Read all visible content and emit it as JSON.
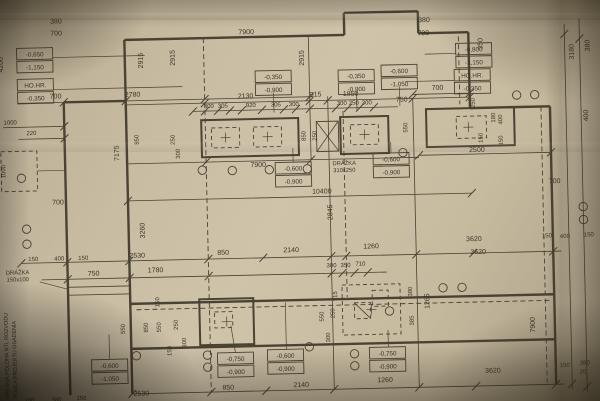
{
  "meta": {
    "width": 600,
    "height": 401,
    "rotation_deg": -1.3,
    "paper_color": "#c9bda4",
    "line_color": "#4a4233",
    "text_color": "#3a3327"
  },
  "plan": {
    "walls": [
      [
        128,
        36,
        348,
        36
      ],
      [
        348,
        14,
        348,
        36
      ],
      [
        348,
        14,
        422,
        14
      ],
      [
        422,
        14,
        422,
        36
      ],
      [
        422,
        36,
        472,
        36
      ],
      [
        472,
        36,
        472,
        112
      ],
      [
        472,
        112,
        552,
        112
      ],
      [
        552,
        112,
        552,
        390
      ],
      [
        66,
        97,
        128,
        97
      ],
      [
        66,
        97,
        66,
        390
      ],
      [
        128,
        36,
        128,
        390
      ],
      [
        128,
        300,
        552,
        300
      ],
      [
        128,
        345,
        552,
        345
      ]
    ],
    "thin_lines": [
      [
        20,
        97,
        315,
        97
      ],
      [
        128,
        101,
        472,
        101
      ],
      [
        195,
        109,
        400,
        109
      ],
      [
        128,
        160,
        420,
        160
      ],
      [
        128,
        197,
        472,
        197
      ],
      [
        20,
        257,
        560,
        257
      ],
      [
        40,
        274,
        385,
        274
      ],
      [
        128,
        390,
        560,
        390
      ],
      [
        420,
        158,
        552,
        158
      ],
      [
        415,
        97,
        472,
        97
      ],
      [
        5,
        121,
        66,
        121
      ],
      [
        20,
        133,
        66,
        133
      ],
      [
        312,
        36,
        312,
        160
      ],
      [
        330,
        97,
        330,
        390
      ],
      [
        415,
        101,
        415,
        390
      ],
      [
        568,
        30,
        568,
        395
      ],
      [
        583,
        25,
        583,
        398
      ],
      [
        66,
        282,
        128,
        282
      ],
      [
        66,
        290,
        128,
        290
      ]
    ],
    "dashed_lines": [
      [
        207,
        36,
        207,
        390
      ],
      [
        462,
        40,
        462,
        108
      ],
      [
        543,
        112,
        543,
        388
      ],
      [
        345,
        112,
        345,
        298
      ],
      [
        134,
        306,
        548,
        306
      ]
    ],
    "rects": [
      {
        "x": 203,
        "y": 118,
        "w": 97,
        "h": 37,
        "s": "heavy"
      },
      {
        "x": 342,
        "y": 118,
        "w": 48,
        "h": 37,
        "s": "heavy"
      },
      {
        "x": 428,
        "y": 112,
        "w": 88,
        "h": 38,
        "s": "heavy"
      },
      {
        "x": 197,
        "y": 297,
        "w": 54,
        "h": 46,
        "s": "heavy"
      },
      {
        "x": 318,
        "y": 122,
        "w": 22,
        "h": 30,
        "s": "thin"
      },
      {
        "x": 213,
        "y": 126,
        "w": 28,
        "h": 20,
        "d": 1
      },
      {
        "x": 255,
        "y": 126,
        "w": 28,
        "h": 20,
        "d": 1
      },
      {
        "x": 352,
        "y": 126,
        "w": 28,
        "h": 20,
        "d": 1
      },
      {
        "x": 458,
        "y": 120,
        "w": 30,
        "h": 22,
        "d": 1
      },
      {
        "x": 212,
        "y": 310,
        "w": 18,
        "h": 16,
        "d": 1
      },
      {
        "x": 340,
        "y": 286,
        "w": 58,
        "h": 50,
        "d": 1
      },
      {
        "x": 352,
        "y": 304,
        "w": 16,
        "h": 16,
        "d": 1
      },
      {
        "x": 370,
        "y": 292,
        "w": 16,
        "h": 16,
        "d": 1
      },
      {
        "x": 2,
        "y": 145,
        "w": 36,
        "h": 40,
        "d": 1
      }
    ],
    "diagonals": [
      [
        318,
        122,
        340,
        152
      ],
      [
        340,
        122,
        318,
        152
      ],
      [
        352,
        304,
        368,
        320
      ]
    ],
    "ticks": [
      [
        66,
        97
      ],
      [
        128,
        97
      ],
      [
        207,
        97
      ],
      [
        312,
        97
      ],
      [
        207,
        101
      ],
      [
        312,
        101
      ],
      [
        330,
        101
      ],
      [
        415,
        101
      ],
      [
        472,
        101
      ],
      [
        195,
        109
      ],
      [
        207,
        109
      ],
      [
        220,
        109
      ],
      [
        232,
        109
      ],
      [
        244,
        109
      ],
      [
        264,
        109
      ],
      [
        286,
        109
      ],
      [
        298,
        109
      ],
      [
        312,
        109
      ],
      [
        338,
        109
      ],
      [
        350,
        109
      ],
      [
        362,
        109
      ],
      [
        376,
        109
      ],
      [
        207,
        160
      ],
      [
        312,
        160
      ],
      [
        128,
        197
      ],
      [
        472,
        197
      ],
      [
        20,
        257
      ],
      [
        66,
        257
      ],
      [
        128,
        257
      ],
      [
        207,
        257
      ],
      [
        262,
        257
      ],
      [
        330,
        257
      ],
      [
        345,
        257
      ],
      [
        415,
        257
      ],
      [
        472,
        257
      ],
      [
        552,
        257
      ],
      [
        66,
        274
      ],
      [
        128,
        274
      ],
      [
        207,
        274
      ],
      [
        330,
        274
      ],
      [
        341,
        274
      ],
      [
        353,
        274
      ],
      [
        366,
        274
      ],
      [
        128,
        390
      ],
      [
        207,
        390
      ],
      [
        262,
        390
      ],
      [
        330,
        390
      ],
      [
        415,
        390
      ],
      [
        472,
        390
      ],
      [
        552,
        390
      ],
      [
        420,
        158
      ],
      [
        552,
        158
      ],
      [
        66,
        121
      ],
      [
        66,
        133
      ],
      [
        415,
        97
      ],
      [
        472,
        97
      ],
      [
        568,
        40
      ],
      [
        568,
        390
      ],
      [
        583,
        45
      ],
      [
        583,
        393
      ]
    ],
    "leaders": [
      [
        56,
        52,
        148,
        52
      ],
      [
        56,
        84,
        185,
        84
      ],
      [
        428,
        57,
        459,
        57
      ],
      [
        408,
        84,
        457,
        84
      ],
      [
        276,
        92,
        276,
        112
      ],
      [
        359,
        93,
        359,
        112
      ],
      [
        402,
        89,
        402,
        108
      ],
      [
        294,
        148,
        294,
        162
      ],
      [
        392,
        144,
        392,
        155
      ],
      [
        106,
        330,
        106,
        355
      ],
      [
        228,
        324,
        232,
        351
      ],
      [
        283,
        302,
        283,
        349
      ],
      [
        385,
        332,
        385,
        349
      ],
      [
        38,
        165,
        66,
        165
      ],
      [
        38,
        276,
        66,
        284
      ]
    ],
    "crosses": [
      [
        227,
        136
      ],
      [
        269,
        136
      ],
      [
        366,
        136
      ],
      [
        470,
        131
      ],
      [
        224,
        320
      ],
      [
        369,
        311
      ]
    ],
    "markers": [
      [
        519,
        100
      ],
      [
        537,
        100
      ],
      [
        583,
        213
      ],
      [
        583,
        226
      ],
      [
        441,
        291
      ],
      [
        460,
        291
      ],
      [
        26,
        223
      ],
      [
        26,
        238
      ],
      [
        203,
        168
      ],
      [
        233,
        169
      ],
      [
        270,
        169
      ],
      [
        308,
        169
      ],
      [
        404,
        155
      ],
      [
        204,
        353
      ],
      [
        204,
        365
      ],
      [
        306,
        347
      ],
      [
        351,
        355
      ],
      [
        351,
        367
      ],
      [
        133,
        352
      ],
      [
        387,
        313
      ],
      [
        22,
        172
      ]
    ]
  },
  "labels": {
    "dims": [
      {
        "t": "380",
        "x": 60,
        "y": 18
      },
      {
        "t": "700",
        "x": 60,
        "y": 30
      },
      {
        "t": "380",
        "x": 428,
        "y": 25
      },
      {
        "t": "700",
        "x": 427,
        "y": 38
      },
      {
        "t": "7900",
        "x": 250,
        "y": 33
      },
      {
        "t": "2915",
        "x": 146,
        "y": 57,
        "r": -90
      },
      {
        "t": "2915",
        "x": 178,
        "y": 55,
        "r": -90
      },
      {
        "t": "2915",
        "x": 307,
        "y": 58,
        "r": -90
      },
      {
        "t": "4200",
        "x": 6,
        "y": 58,
        "r": -90
      },
      {
        "t": "350",
        "x": 486,
        "y": 48,
        "r": -90
      },
      {
        "t": "3180",
        "x": 577,
        "y": 58,
        "r": -90
      },
      {
        "t": "380",
        "x": 593,
        "y": 52,
        "r": -90
      },
      {
        "t": "400",
        "x": 590,
        "y": 122,
        "r": -90
      },
      {
        "t": "700",
        "x": 58,
        "y": 93
      },
      {
        "t": "2780",
        "x": 135,
        "y": 93
      },
      {
        "t": "700",
        "x": 440,
        "y": 93
      },
      {
        "t": "2130",
        "x": 248,
        "y": 97
      },
      {
        "t": "915",
        "x": 318,
        "y": 97
      },
      {
        "t": "1850",
        "x": 353,
        "y": 97
      },
      {
        "t": "750",
        "x": 404,
        "y": 104
      },
      {
        "t": "300",
        "x": 211,
        "y": 106,
        "s": 6
      },
      {
        "t": "305",
        "x": 225,
        "y": 106,
        "s": 6
      },
      {
        "t": "920",
        "x": 253,
        "y": 106,
        "s": 6
      },
      {
        "t": "305",
        "x": 278,
        "y": 106,
        "s": 6
      },
      {
        "t": "300",
        "x": 296,
        "y": 106,
        "s": 6
      },
      {
        "t": "300",
        "x": 344,
        "y": 106,
        "s": 6
      },
      {
        "t": "250",
        "x": 356,
        "y": 106,
        "s": 6
      },
      {
        "t": "300",
        "x": 369,
        "y": 106,
        "s": 6
      },
      {
        "t": "850",
        "x": 307,
        "y": 136,
        "r": -90,
        "s": 6
      },
      {
        "t": "250",
        "x": 318,
        "y": 136,
        "r": -90,
        "s": 6
      },
      {
        "t": "550",
        "x": 409,
        "y": 130,
        "r": -90,
        "s": 6
      },
      {
        "t": "250",
        "x": 477,
        "y": 107,
        "r": -90,
        "s": 6
      },
      {
        "t": "180",
        "x": 497,
        "y": 122,
        "r": -90,
        "s": 6
      },
      {
        "t": "400",
        "x": 504,
        "y": 124,
        "r": -90,
        "s": 6
      },
      {
        "t": "150",
        "x": 484,
        "y": 142,
        "r": -90,
        "s": 6
      },
      {
        "t": "150",
        "x": 504,
        "y": 145,
        "r": -90,
        "s": 6
      },
      {
        "t": "7900",
        "x": 259,
        "y": 166
      },
      {
        "t": "2500",
        "x": 478,
        "y": 156
      },
      {
        "t": "1000",
        "x": 12,
        "y": 118,
        "s": 6
      },
      {
        "t": "220",
        "x": 33,
        "y": 129,
        "s": 6
      },
      {
        "t": "1000",
        "x": 6,
        "y": 165,
        "r": -90,
        "s": 6
      },
      {
        "t": "7175",
        "x": 120,
        "y": 149,
        "r": -90
      },
      {
        "t": "850",
        "x": 140,
        "y": 136,
        "r": -90,
        "s": 6
      },
      {
        "t": "250",
        "x": 176,
        "y": 137,
        "r": -90,
        "s": 6
      },
      {
        "t": "300",
        "x": 181,
        "y": 151,
        "r": -90,
        "s": 6
      },
      {
        "t": "700",
        "x": 58,
        "y": 199
      },
      {
        "t": "700",
        "x": 555,
        "y": 189
      },
      {
        "t": "10400",
        "x": 322,
        "y": 194
      },
      {
        "t": "2845",
        "x": 332,
        "y": 213,
        "r": -90
      },
      {
        "t": "3260",
        "x": 144,
        "y": 227,
        "r": -90
      },
      {
        "t": "3620",
        "x": 473,
        "y": 245
      },
      {
        "t": "3620",
        "x": 477,
        "y": 258
      },
      {
        "t": "150",
        "x": 546,
        "y": 243,
        "s": 6
      },
      {
        "t": "400",
        "x": 564,
        "y": 244,
        "s": 6
      },
      {
        "t": "150",
        "x": 588,
        "y": 243,
        "s": 6
      },
      {
        "t": "150",
        "x": 32,
        "y": 255,
        "s": 6
      },
      {
        "t": "400",
        "x": 58,
        "y": 255,
        "s": 6
      },
      {
        "t": "150",
        "x": 82,
        "y": 255,
        "s": 6
      },
      {
        "t": "2530",
        "x": 136,
        "y": 254
      },
      {
        "t": "850",
        "x": 222,
        "y": 253
      },
      {
        "t": "2140",
        "x": 290,
        "y": 252
      },
      {
        "t": "1260",
        "x": 370,
        "y": 250
      },
      {
        "t": "750",
        "x": 92,
        "y": 271
      },
      {
        "t": "1780",
        "x": 154,
        "y": 269
      },
      {
        "t": "300",
        "x": 330,
        "y": 268,
        "s": 6
      },
      {
        "t": "350",
        "x": 344,
        "y": 268,
        "s": 6
      },
      {
        "t": "710",
        "x": 359,
        "y": 267,
        "s": 6
      },
      {
        "t": "150",
        "x": 157,
        "y": 299,
        "r": -90,
        "s": 6
      },
      {
        "t": "550",
        "x": 122,
        "y": 325,
        "r": -90,
        "s": 6
      },
      {
        "t": "850",
        "x": 145,
        "y": 324,
        "r": -90,
        "s": 6
      },
      {
        "t": "550",
        "x": 158,
        "y": 324,
        "r": -90,
        "s": 6
      },
      {
        "t": "250",
        "x": 175,
        "y": 322,
        "r": -90,
        "s": 6
      },
      {
        "t": "300",
        "x": 183,
        "y": 340,
        "r": -90,
        "s": 6
      },
      {
        "t": "150",
        "x": 168,
        "y": 348,
        "r": -90,
        "s": 6
      },
      {
        "t": "715",
        "x": 335,
        "y": 297,
        "r": -90,
        "s": 6
      },
      {
        "t": "550",
        "x": 321,
        "y": 317,
        "r": -90,
        "s": 6
      },
      {
        "t": "250",
        "x": 332,
        "y": 314,
        "r": -90,
        "s": 6
      },
      {
        "t": "300",
        "x": 327,
        "y": 338,
        "r": -90,
        "s": 6
      },
      {
        "t": "380",
        "x": 410,
        "y": 294,
        "r": -90,
        "s": 6
      },
      {
        "t": "1265",
        "x": 427,
        "y": 304,
        "r": -90
      },
      {
        "t": "385",
        "x": 411,
        "y": 323,
        "r": -90,
        "s": 6
      },
      {
        "t": "7900",
        "x": 532,
        "y": 330,
        "r": -90
      },
      {
        "t": "850",
        "x": 224,
        "y": 388
      },
      {
        "t": "2140",
        "x": 297,
        "y": 387
      },
      {
        "t": "1260",
        "x": 381,
        "y": 384
      },
      {
        "t": "2530",
        "x": 137,
        "y": 392
      },
      {
        "t": "3620",
        "x": 489,
        "y": 377
      },
      {
        "t": "150",
        "x": 561,
        "y": 373,
        "s": 6
      },
      {
        "t": "380",
        "x": 581,
        "y": 371,
        "s": 6
      },
      {
        "t": "20",
        "x": 579,
        "y": 380,
        "s": 6
      },
      {
        "t": "150",
        "x": 25,
        "y": 396,
        "s": 6
      },
      {
        "t": "380",
        "x": 52,
        "y": 396,
        "s": 6
      },
      {
        "t": "150",
        "x": 77,
        "y": 395,
        "s": 6
      }
    ],
    "elevation_boxes": [
      {
        "x": 20,
        "y": 42,
        "lines": [
          "-0,650",
          "-1,150"
        ]
      },
      {
        "x": 20,
        "y": 73,
        "lines": [
          "HO.HR.",
          "-0,350"
        ]
      },
      {
        "x": 258,
        "y": 70,
        "lines": [
          "-0,350",
          "-0,900"
        ]
      },
      {
        "x": 341,
        "y": 71,
        "lines": [
          "-0,350",
          "-0,900"
        ]
      },
      {
        "x": 384,
        "y": 67,
        "lines": [
          "-0,600",
          "-1,050"
        ]
      },
      {
        "x": 459,
        "y": 47,
        "lines": [
          "-0,800",
          "-1,150"
        ]
      },
      {
        "x": 457,
        "y": 73,
        "lines": [
          "HO.HR.",
          "-0,350"
        ]
      },
      {
        "x": 276,
        "y": 162,
        "lines": [
          "-0,600",
          "-0,900"
        ]
      },
      {
        "x": 374,
        "y": 155,
        "lines": [
          "-0,600",
          "-0,900"
        ]
      },
      {
        "x": 88,
        "y": 355,
        "lines": [
          "-0,600",
          "-1,050"
        ]
      },
      {
        "x": 214,
        "y": 351,
        "lines": [
          "-0,750",
          "-0,900"
        ]
      },
      {
        "x": 264,
        "y": 349,
        "lines": [
          "-0,600",
          "-0,900"
        ]
      },
      {
        "x": 366,
        "y": 349,
        "lines": [
          "-0,750",
          "-0,900"
        ]
      }
    ],
    "notes": [
      {
        "t": "DRÁŽKA",
        "x": 16,
        "y": 268,
        "s": 5.8
      },
      {
        "t": "150x100",
        "x": 16,
        "y": 275,
        "s": 5.8
      },
      {
        "t": "DRÁŽKA",
        "x": 345,
        "y": 166,
        "s": 5.8
      },
      {
        "t": "310x250",
        "x": 345,
        "y": 173,
        "s": 5.8
      },
      {
        "t": "PRESNÁ POLOHA NTL ROZVODU",
        "x": 5,
        "y": 392,
        "r": -90,
        "s": 5.4,
        "a": "start"
      },
      {
        "t": "PODĽA PROJEKTU OSADENIA",
        "x": 13,
        "y": 392,
        "r": -90,
        "s": 5.4,
        "a": "start"
      }
    ]
  }
}
